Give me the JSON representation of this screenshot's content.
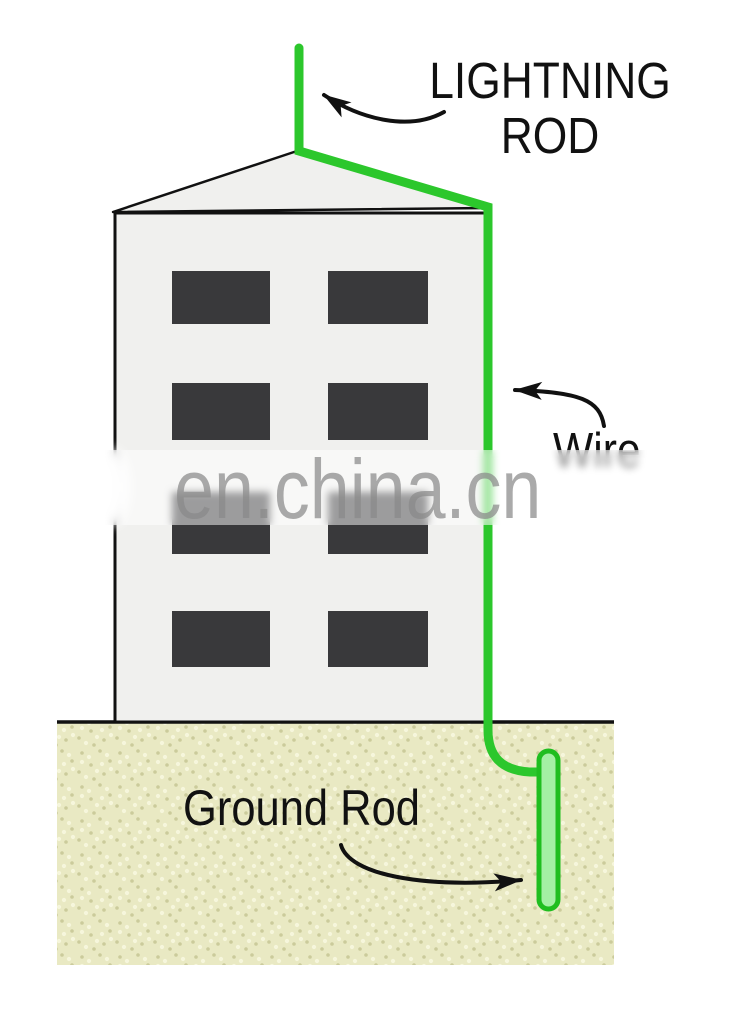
{
  "diagram": {
    "title_label": {
      "line1": "LIGHTNING",
      "line2": "ROD"
    },
    "wire_label": "Wire",
    "ground_rod_label": "Ground Rod",
    "watermark": "en.china.cn",
    "parts": {
      "lightning_rod": "lightning rod on roof peak",
      "wire": "down-conductor wire along roof slope and wall",
      "building": "four-story building with eight windows",
      "ground": "soil cross-section",
      "ground_rod": "buried grounding rod"
    }
  },
  "colors": {
    "wire-green": "#2cc72c",
    "rod-fill": "#a4f0a4",
    "rod-stroke": "#1fbe1f",
    "building-fill": "#f0f0ee",
    "window-fill": "#39393b",
    "ground-fill": "#e9e9c3",
    "ground-dot-dark": "#cbcb9b",
    "ground-dot-light": "#f6f6dc",
    "outline": "#111111",
    "watermark-gray": "#8a8a8a"
  }
}
